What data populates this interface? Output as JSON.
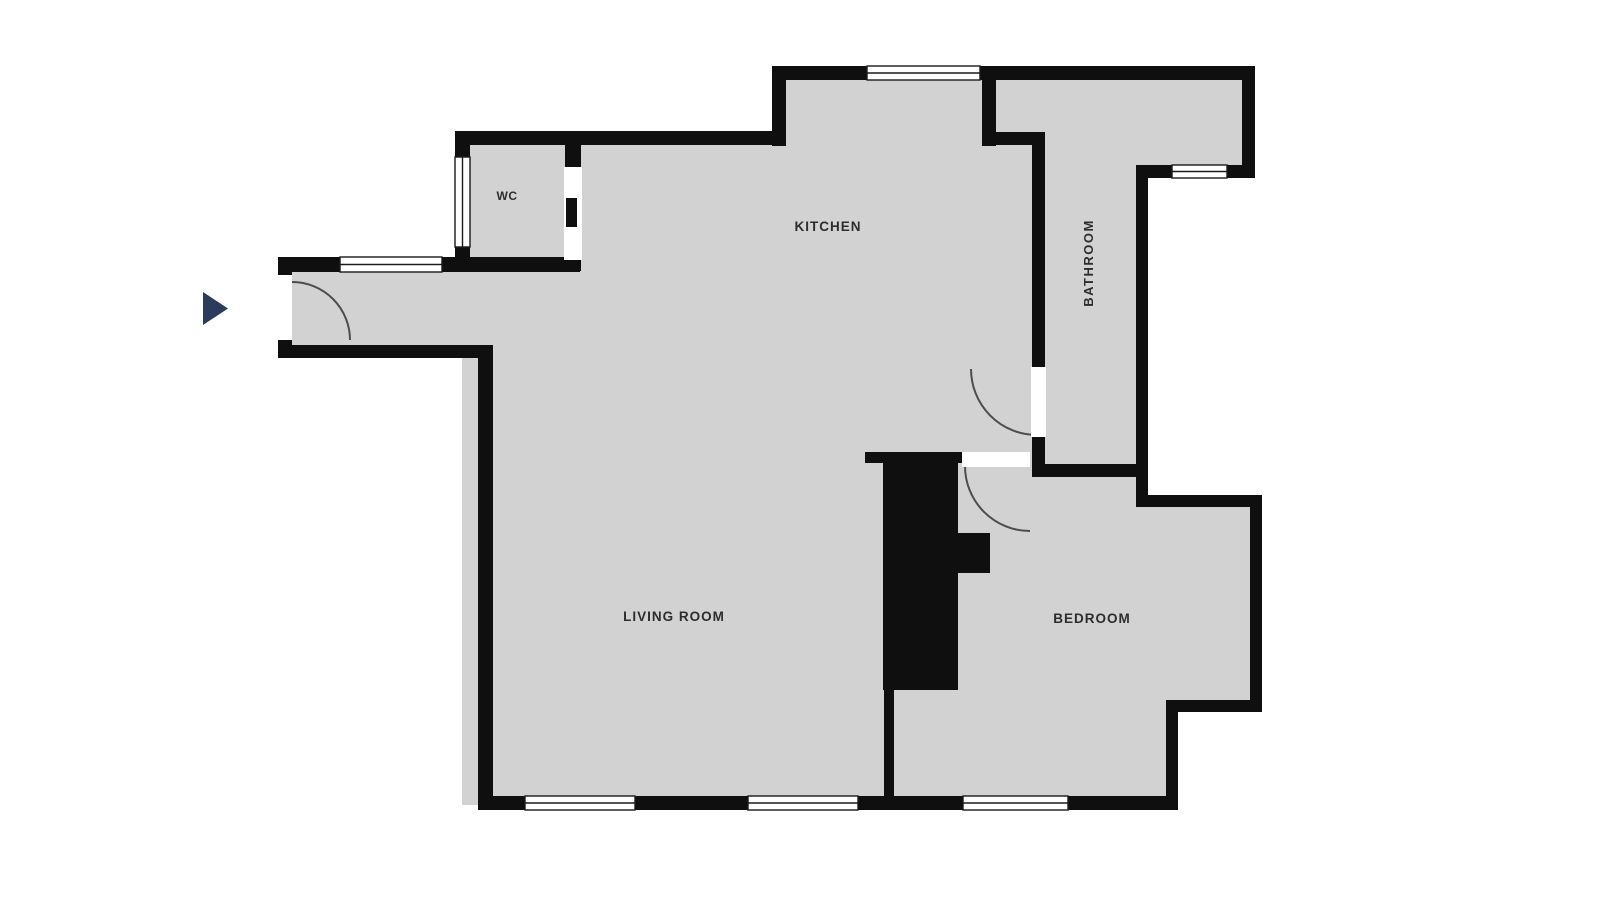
{
  "title": "Apartment floor plan",
  "colors": {
    "background": "#ffffff",
    "floor": "#d2d2d2",
    "wall": "#0f0f0f",
    "window_fill": "#ffffff",
    "window_frame": "#1a1a1a",
    "door_opening": "#ffffff",
    "door_arc": "#4d4d4d",
    "label": "#2d2d2d",
    "marker": "#2a3b5e"
  },
  "rooms": [
    {
      "id": "wc",
      "label": "WC"
    },
    {
      "id": "kitchen",
      "label": "KITCHEN"
    },
    {
      "id": "bathroom",
      "label": "BATHROOM",
      "label_rotation": -90
    },
    {
      "id": "living_room",
      "label": "LIVING ROOM"
    },
    {
      "id": "bedroom",
      "label": "BEDROOM"
    }
  ],
  "marker": {
    "icon": "play-triangle-icon",
    "direction": "right"
  }
}
